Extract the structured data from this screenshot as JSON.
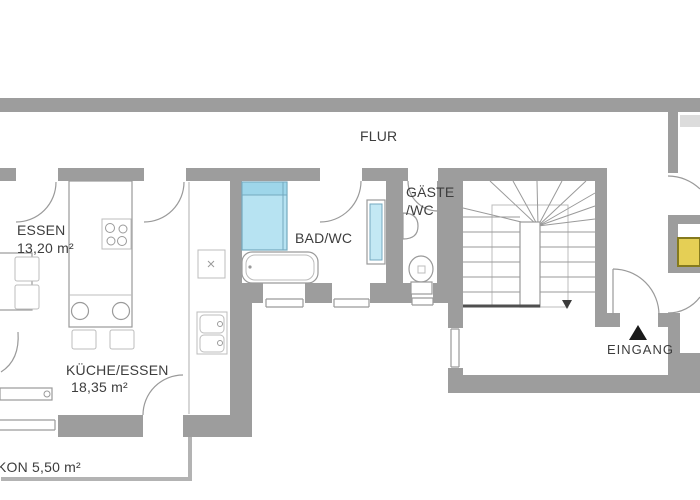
{
  "labels": {
    "flur": "FLUR",
    "essen_name": "ESSEN",
    "essen_area": "13,20 m²",
    "bad_wc": "BAD/WC",
    "gaeste_line1": "GÄSTE",
    "gaeste_line2": "/WC",
    "kueche_name": "KÜCHE/ESSEN",
    "kueche_area": "18,35 m²",
    "eingang": "EINGANG",
    "balkon": "KON 5,50 m²"
  },
  "colors": {
    "wall": "#9d9d9d",
    "wall-light": "#b3b3b3",
    "line": "#9a9a9a",
    "line-light": "#bcbcbc",
    "text": "#3d3d3d",
    "shower-fill": "#b7e3f2",
    "shower-header": "#9ed6ea",
    "fixture-blue-border": "#74a9bf",
    "radiator-fill": "#c3e8f4",
    "furniture-yellow": "#e5cf55",
    "furniture-yellow-border": "#857a1e",
    "shelf-gray": "#dcdcdc",
    "stair-base": "#4f4f4f",
    "marker-black": "#1a1a1a"
  },
  "icons": {
    "entrance_arrow": "triangle-up",
    "stair_direction_arrow": "triangle-down"
  }
}
